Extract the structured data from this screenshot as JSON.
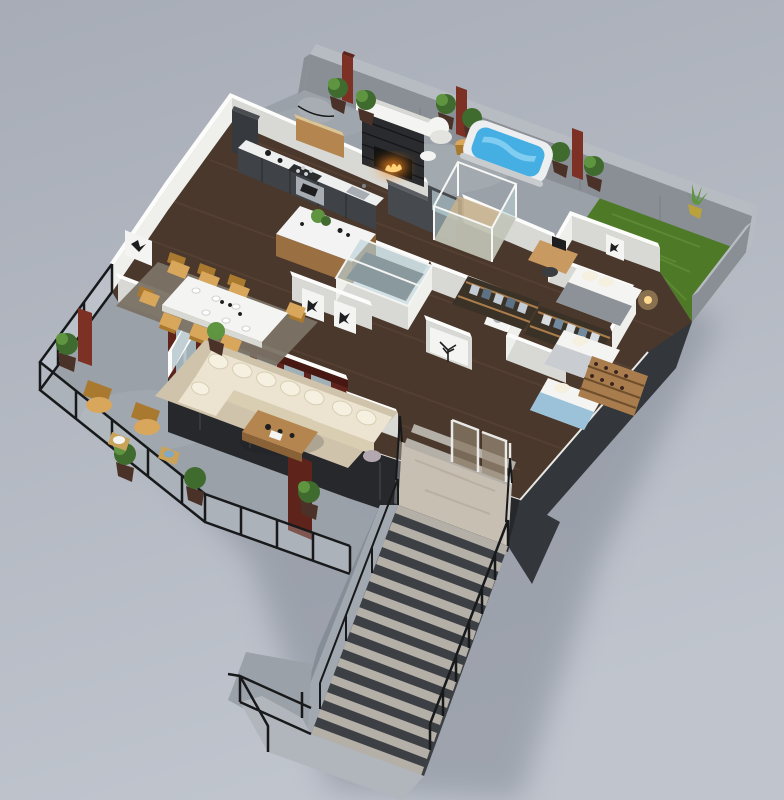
{
  "scene": {
    "type": "3d-isometric-floor-plan-render",
    "description": "Photoreal 3D isometric cutaway floor plan of a penthouse level with wraparound terrace, roof patio, lawn and a grand exterior staircase descending to the lower level",
    "areas": [
      {
        "name": "roof-patio",
        "objects": [
          "stone-fireplace",
          "fire",
          "rust-planter-columns",
          "potted-plants",
          "barbecue-grill",
          "grill-cabinet",
          "white-armchair",
          "wood-stool",
          "side-table",
          "hot-tub"
        ]
      },
      {
        "name": "lawn",
        "objects": [
          "grass",
          "corner-plant"
        ]
      },
      {
        "name": "kitchen",
        "objects": [
          "dark-cabinet-run",
          "white-countertop",
          "cooktop",
          "oven",
          "sink",
          "tall-cabinet",
          "kitchen-island",
          "island-plant"
        ]
      },
      {
        "name": "dining-room",
        "objects": [
          "gray-rug",
          "white-dining-table",
          "tan-chairs",
          "tableware",
          "bird-wall-art"
        ]
      },
      {
        "name": "living-room",
        "objects": [
          "beige-rug",
          "cream-sectional-sofa",
          "throw-pillows",
          "wood-coffee-table",
          "butterfly-wall-art-pair",
          "portrait-wall-art"
        ]
      },
      {
        "name": "terrace-balcony",
        "objects": [
          "glass-railing",
          "black-railing-frame",
          "lounge-chairs",
          "gold-side-tables",
          "potted-plants",
          "rust-planter-column"
        ]
      },
      {
        "name": "core",
        "objects": [
          "glass-roof-atrium",
          "charcoal-feature-wall",
          "patio-glass-door"
        ]
      },
      {
        "name": "bathroom",
        "objects": [
          "glass-shower-box",
          "laundry-appliance"
        ]
      },
      {
        "name": "closets",
        "objects": [
          "wardrobe-strip-a",
          "wardrobe-strip-b",
          "hanging-clothes"
        ]
      },
      {
        "name": "bedroom-northeast",
        "objects": [
          "bed-gray-blanket",
          "pillows",
          "butterfly-art",
          "desk",
          "monitor",
          "desk-chair",
          "bedside-lamp"
        ]
      },
      {
        "name": "bedroom-middle",
        "objects": [
          "bed-white"
        ]
      },
      {
        "name": "bedroom-east",
        "objects": [
          "bed-blue-throw",
          "wine-rack",
          "tree-wall-art"
        ]
      },
      {
        "name": "entry",
        "objects": [
          "travertine-landing",
          "glass-doors",
          "glass-guard-rails",
          "interior-steps"
        ]
      },
      {
        "name": "staircase",
        "objects": [
          "stone-treads",
          "dark-risers",
          "black-handrails",
          "concrete-stringer-wall",
          "lower-landing",
          "lower-railing"
        ]
      },
      {
        "name": "shell",
        "objects": [
          "back-concrete-wall",
          "right-garden-wall",
          "dark-east-facade",
          "burgundy-window-wall",
          "white-west-walls",
          "dark-understructure"
        ]
      }
    ]
  },
  "palette": {
    "bg_top": "#a7acb6",
    "bg_bottom": "#bfc4cd",
    "shadow": "#7e8490",
    "concrete_wall": "#8a8e95",
    "concrete_wall_top": "#b7bcc2",
    "concrete_floor": "#9ba1a8",
    "concrete_light": "#b0b6bc",
    "grass": "#4e7a28",
    "grass_light": "#69973c",
    "wood_floor": "#4a382c",
    "wood_plank": "#62493a",
    "wall_face": "#efefec",
    "wall_shade": "#d8d8d4",
    "wall_cap": "#fcfcfb",
    "charcoal": "#46494e",
    "charcoal_top": "#5a5d62",
    "dark_base": "#26282b",
    "facade": "#33363b",
    "burgundy": "#5e241b",
    "burgundy_dark": "#471811",
    "glass": "#a9bec6",
    "glass_blue": "#bcd3d8",
    "water": "#45aee3",
    "water_light": "#8fd4f4",
    "tub_shell": "#eceeef",
    "cream_sofa": "#ece4d0",
    "cream_shade": "#d9cdb2",
    "pillow": "#f6f0e0",
    "rug_beige": "#cfc3ab",
    "rug_gray": "#7b7265",
    "wood_furn": "#b5854f",
    "wood_furn_dark": "#8a6238",
    "tan_chair": "#d8a75c",
    "tan_dark": "#a9792f",
    "fire": "#ff8c1f",
    "fire_light": "#ffd27a",
    "plant": "#3f6b2f",
    "plant_light": "#5f9440",
    "pot": "#4a3228",
    "rust": "#7c3124",
    "steel": "#a7adb2",
    "black_rail": "#17191b",
    "stone_landing": "#c7bfb2",
    "step_tread": "#b4afa7",
    "step_dark": "#3c3f44",
    "blue_throw": "#9cc2da",
    "gray_blanket": "#8d9299",
    "white": "#f4f4f2",
    "lamp_warm": "#ffd98f",
    "art_dark": "#1e1e20"
  }
}
